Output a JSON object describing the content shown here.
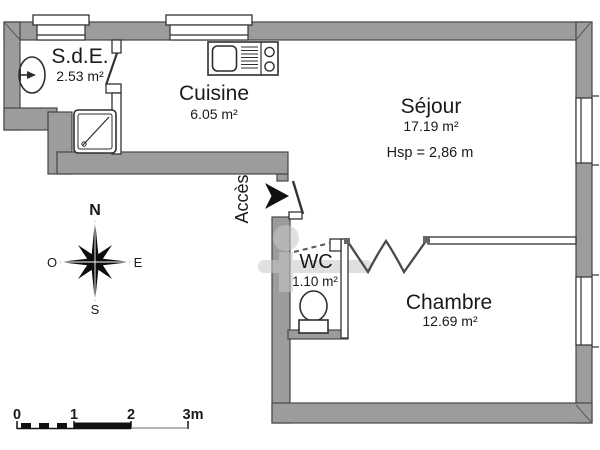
{
  "title": "Plan d'appartement 2 pièces",
  "rooms": {
    "sde": {
      "name": "S.d.E.",
      "area": "2.53 m²"
    },
    "cuisine": {
      "name": "Cuisine",
      "area": "6.05 m²"
    },
    "sejour": {
      "name": "Séjour",
      "area": "17.19 m²",
      "ceiling": "Hsp =  2,86 m"
    },
    "wc": {
      "name": "WC",
      "area": "1.10 m²"
    },
    "chambre": {
      "name": "Chambre",
      "area": "12.69 m²"
    }
  },
  "entrance": {
    "label": "Accès"
  },
  "compass": {
    "north": "N",
    "east": "E",
    "south": "S",
    "west": "O"
  },
  "scale": {
    "ticks": [
      "0",
      "1",
      "2",
      "3m"
    ]
  },
  "icons": {
    "compass": "compass-rose-icon",
    "arrow": "entrance-arrow-icon",
    "basin": "washbasin-icon",
    "shower": "shower-tray-icon",
    "kitchen": "kitchen-sink-hob-icon",
    "toilet": "toilet-icon",
    "scalebar": "scale-bar-icon",
    "watermark": "watermark-logo"
  },
  "colors": {
    "wall_fill": "#9c9c9c",
    "wall_outline": "#474747",
    "line": "#2e2e2e",
    "text": "#1a1a1a",
    "watermark": "#c8c8c8"
  }
}
